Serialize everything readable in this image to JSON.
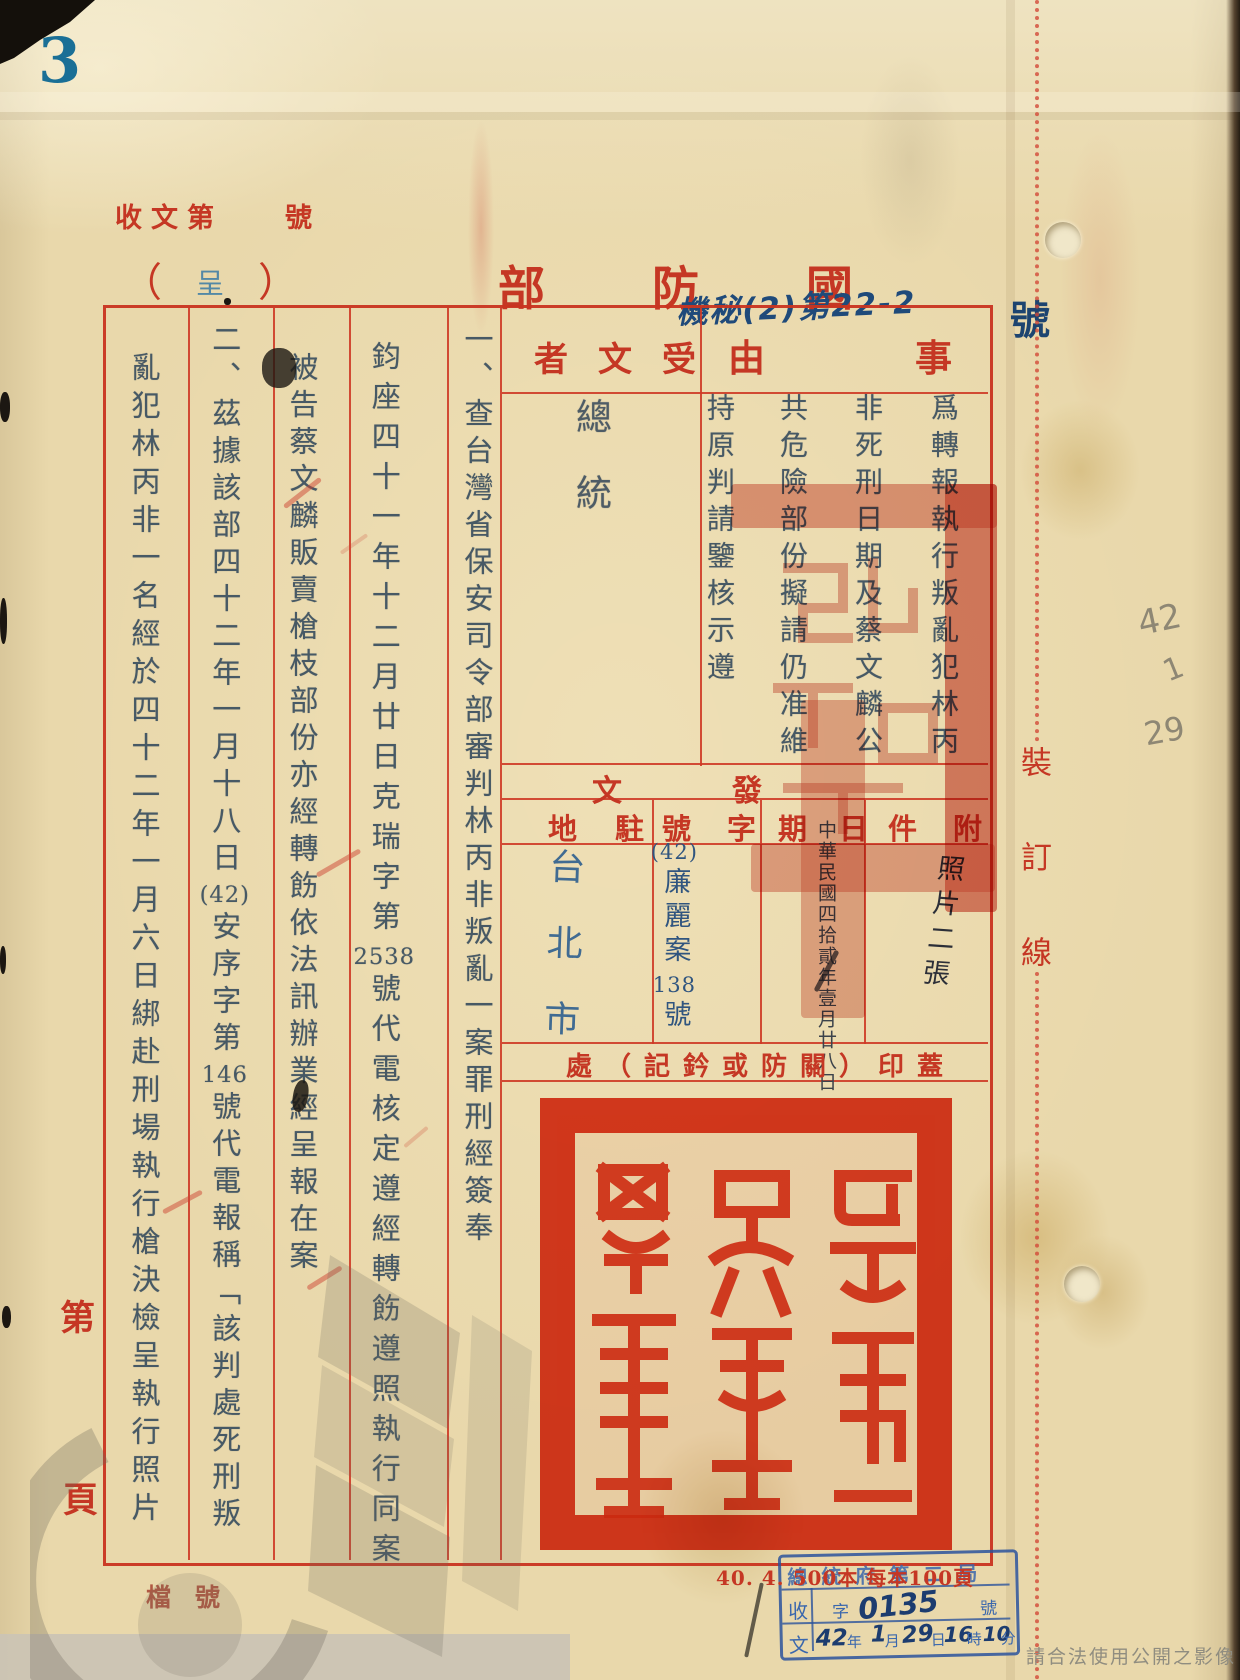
{
  "document": {
    "page_number": "3",
    "received_doc_label": "收文第",
    "received_doc_suffix": "號",
    "paren_left": "（",
    "doc_type_stamp": "呈",
    "paren_right": "）",
    "issuing_org": "國防部",
    "classification_note": "機秘(2)第22-2",
    "classification_suffix": "號"
  },
  "form": {
    "subject_label": "事由",
    "subject_columns": [
      "爲轉報執行叛亂犯林丙",
      "非死刑日期及蔡文麟公",
      "共危險部份擬請仍准維",
      "持原判請鑒核示遵"
    ],
    "recipient_label": "受文者",
    "recipient_value": "總統",
    "body_columns": [
      "一、查台灣省保安司令部審判林丙非叛亂一案罪刑經簽奉",
      "鈞座四十一年十二月廿日克瑞字第2538號代電核定遵經轉飭遵照執行同案",
      "被告蔡文麟販賣槍枝部份亦經轉飭依法訊辦業經呈報在案",
      "二、茲據該部四十二年一月十八日(42)安序字第146號代電報稱﹁該判處死刑叛",
      "亂犯林丙非一名經於四十二年一月六日綁赴刑場執行槍決檢呈執行照片"
    ],
    "dispatch_label": "發文",
    "attachment_label": "附件",
    "attachment_value": "照片二張",
    "date_label": "日期",
    "date_value": "中華民國四拾貳年壹月廿八日",
    "ref_label": "字號",
    "ref_value": "(42)廉麗案138號",
    "station_label": "駐地",
    "station_value": "台北市",
    "seal_area_label": "蓋印（關防或鈐記）處"
  },
  "margins": {
    "binding_line_label": "裝訂線",
    "page_prefix": "第",
    "page_suffix": "頁",
    "archive_no_label": "檔號",
    "pencil_notes": [
      "42",
      "1",
      "29"
    ]
  },
  "footer": {
    "print_run_note": "40. 4. 500本 每本100頁",
    "usage_notice": "請合法使用公開之影像",
    "receipt_stamp": {
      "office": "總統府第二局",
      "receive_char": "收",
      "doc_char": "文",
      "zi_label": "字",
      "doc_number": "0135",
      "hao_label": "號",
      "year": "42",
      "year_label": "年",
      "month": "1",
      "month_label": "月",
      "day": "29",
      "day_label": "日",
      "hour": "16",
      "hour_label": "時",
      "minute": "10",
      "minute_label": "分"
    }
  },
  "colors": {
    "form_red": "#c53724",
    "seal_red": "#e23318",
    "ink_blue_gray": "#475965",
    "stamp_blue": "#2e5f8f",
    "handwriting_blue": "#1f4a7a",
    "pencil_gray": "#8e8774",
    "paper": "#e9d8ab"
  }
}
